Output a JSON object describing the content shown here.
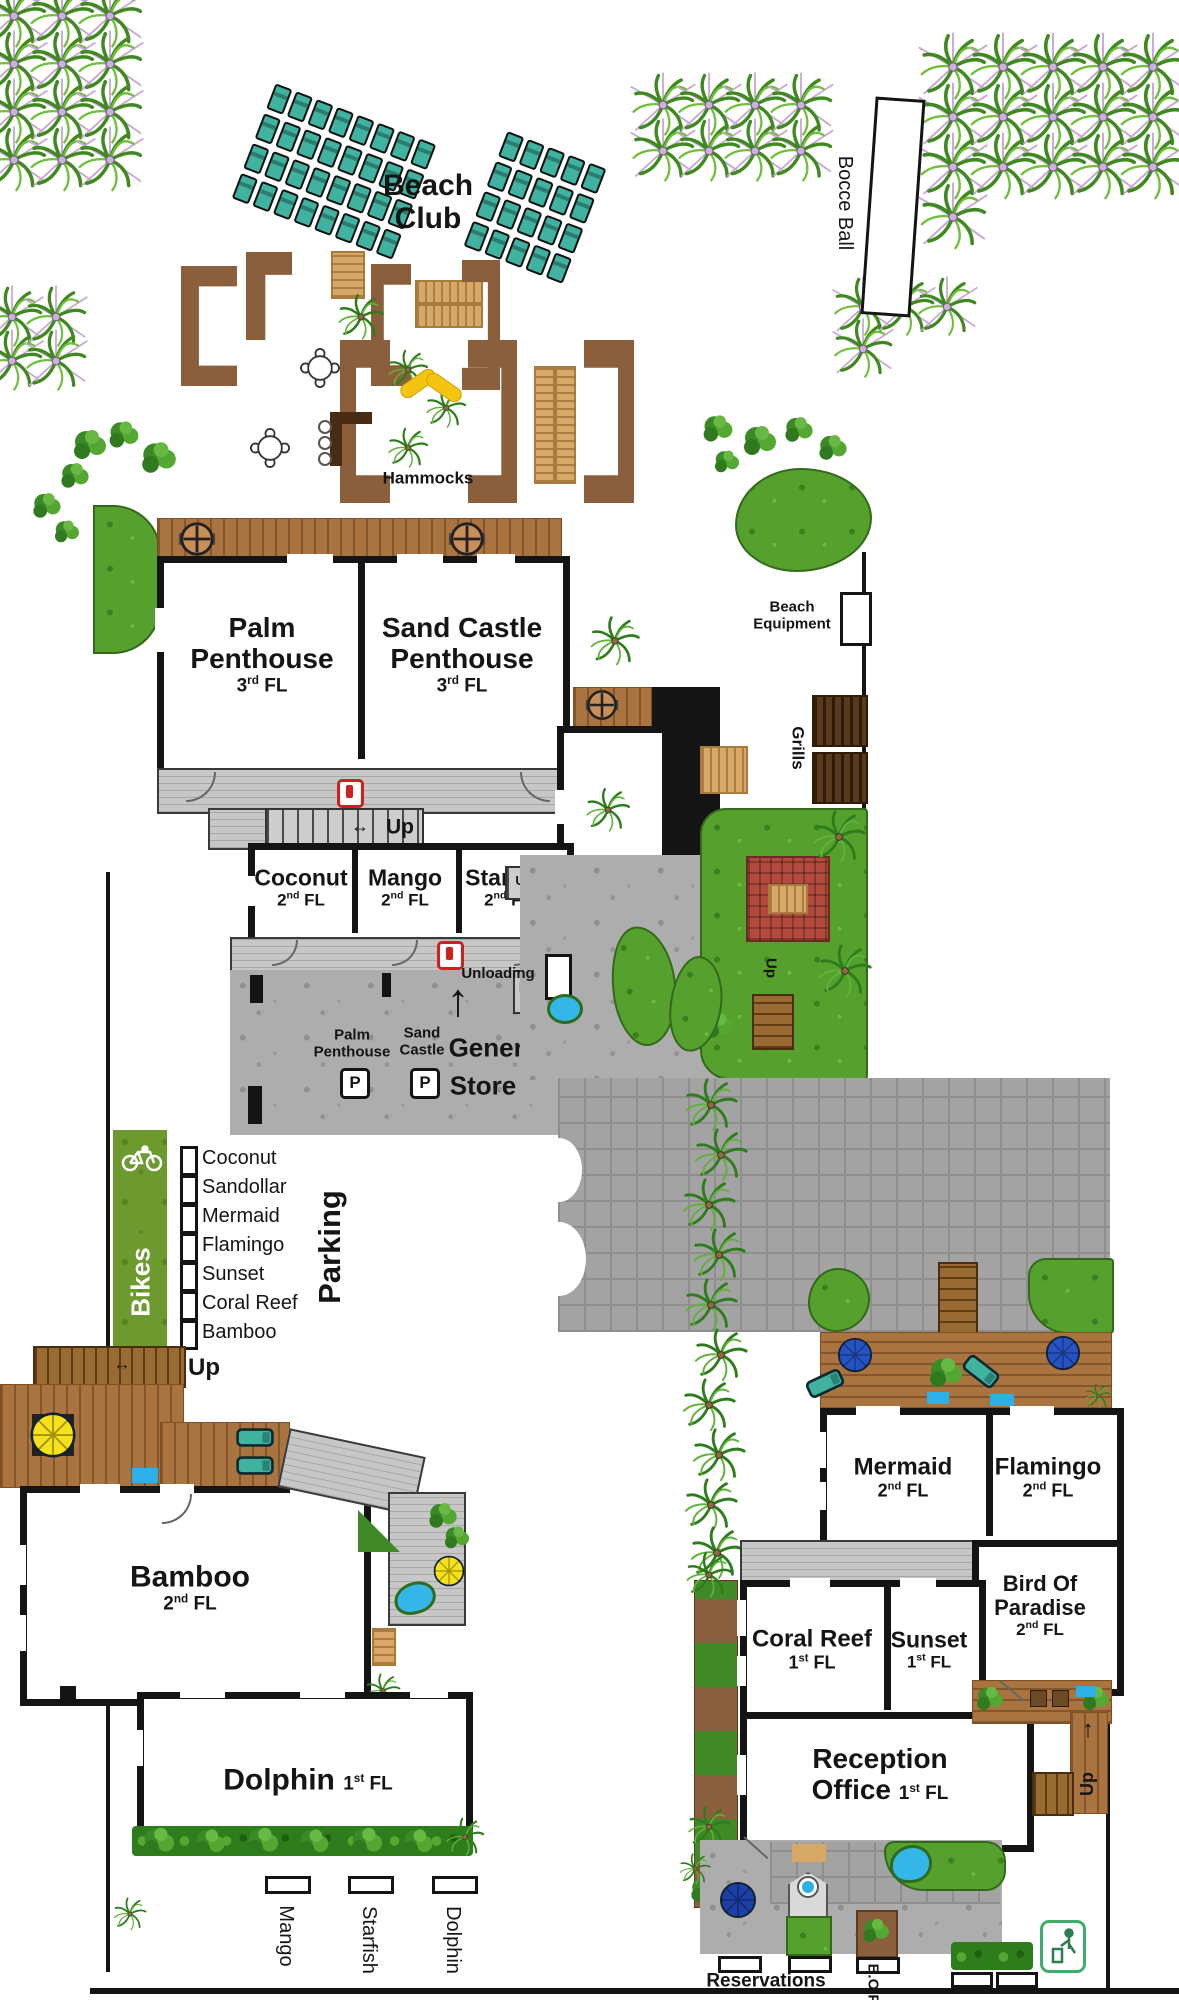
{
  "colors": {
    "wood": "#a9743f",
    "hedge_brown": "#8b5e3c",
    "lawn_green": "#56a12e",
    "chair_teal": "#3fb3a0",
    "fire_red": "#cf1f1f",
    "bikes_green": "#6c9a2f",
    "private_black": "#141414",
    "water_blue": "#35b6e8",
    "pergola_red": "#b34a3e"
  },
  "areas": {
    "beach_club": {
      "line1": "Beach",
      "line2": "Club"
    },
    "bocce": {
      "label": "Bocce Ball"
    },
    "hammocks": {
      "label": "Hammocks"
    },
    "beach_equipment": {
      "line1": "Beach",
      "line2": "Equipment"
    },
    "grills": {
      "label": "Grills"
    },
    "general_store": {
      "line1": "General",
      "line2": "Store"
    },
    "private": {
      "label": "Private"
    },
    "bikes": {
      "label": "Bikes"
    },
    "parking": {
      "label": "Parking"
    },
    "unloading": {
      "label": "Unloading"
    },
    "reservations": {
      "label": "Reservations"
    },
    "bop": {
      "label": "B.O.P"
    }
  },
  "labels": {
    "up": "Up",
    "fl": "FL",
    "p": "P",
    "arrow_h": "↔",
    "arrow_up": "↑"
  },
  "rooms": {
    "palm_penthouse": {
      "l1": "Palm",
      "l2": "Penthouse",
      "num": "3",
      "sup": "rd"
    },
    "sand_castle": {
      "l1": "Sand Castle",
      "l2": "Penthouse",
      "num": "3",
      "sup": "rd"
    },
    "coconut": {
      "name": "Coconut",
      "num": "2",
      "sup": "nd"
    },
    "mango": {
      "name": "Mango",
      "num": "2",
      "sup": "nd"
    },
    "starfish": {
      "name": "Starfish",
      "num": "2",
      "sup": "nd"
    },
    "sand_dollar": {
      "l1": "Sand",
      "l2": "Dollar",
      "num": "2",
      "sup": "nd"
    },
    "bamboo": {
      "name": "Bamboo",
      "num": "2",
      "sup": "nd"
    },
    "dolphin": {
      "name": "Dolphin",
      "num": "1",
      "sup": "st"
    },
    "mermaid": {
      "name": "Mermaid",
      "num": "2",
      "sup": "nd"
    },
    "flamingo": {
      "name": "Flamingo",
      "num": "2",
      "sup": "nd"
    },
    "bird_of_paradise": {
      "l1": "Bird Of",
      "l2": "Paradise",
      "num": "2",
      "sup": "nd"
    },
    "coral_reef": {
      "name": "Coral Reef",
      "num": "1",
      "sup": "st"
    },
    "sunset": {
      "name": "Sunset",
      "num": "1",
      "sup": "st"
    },
    "reception": {
      "l1": "Reception",
      "l2": "Office",
      "num": "1",
      "sup": "st"
    }
  },
  "parking_signs": {
    "palm": {
      "line1": "Palm",
      "line2": "Penthouse"
    },
    "sand": {
      "line1": "Sand",
      "line2": "Castle"
    }
  },
  "parking_list": [
    "Coconut",
    "Sandollar",
    "Mermaid",
    "Flamingo",
    "Sunset",
    "Coral Reef",
    "Bamboo"
  ],
  "parking_spots": [
    "Mango",
    "Starfish",
    "Dolphin"
  ]
}
